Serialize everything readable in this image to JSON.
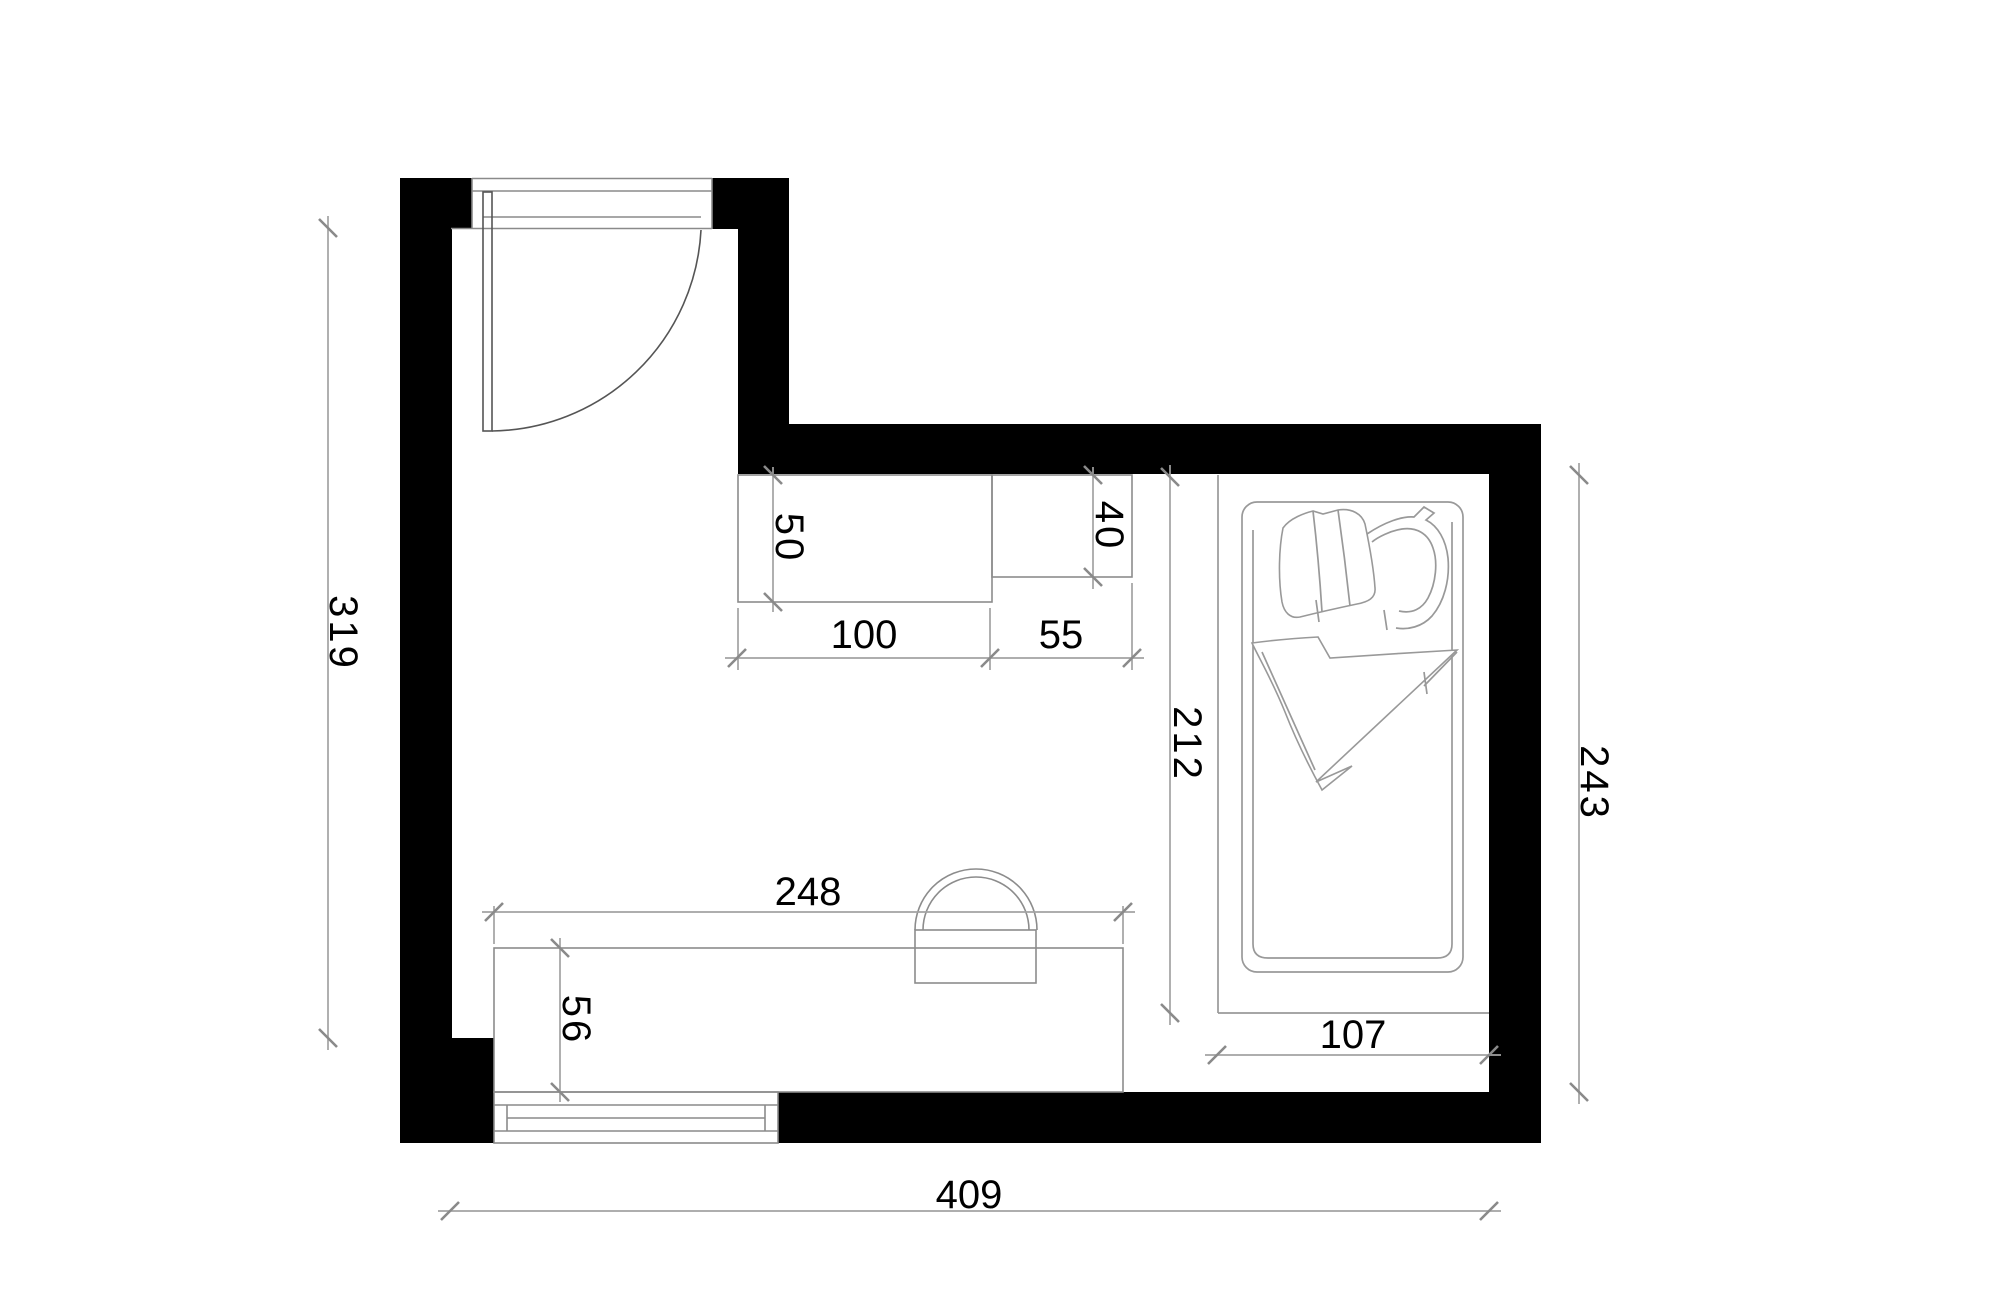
{
  "drawing": {
    "type": "floor-plan",
    "units": "cm",
    "dimensions": {
      "room_height_left": "319",
      "room_width_bottom": "409",
      "room_height_right": "243",
      "bed_zone_height": "212",
      "bed_zone_width": "107",
      "cabinet_width": "100",
      "cabinet_depth": "50",
      "dresser_width": "55",
      "dresser_depth": "40",
      "desk_width": "248",
      "desk_depth": "56"
    },
    "colors": {
      "wall": "#000000",
      "dimension_line": "#a3a3a3",
      "furniture_line": "#8c8c8c",
      "text": "#000000",
      "background": "#ffffff"
    }
  }
}
